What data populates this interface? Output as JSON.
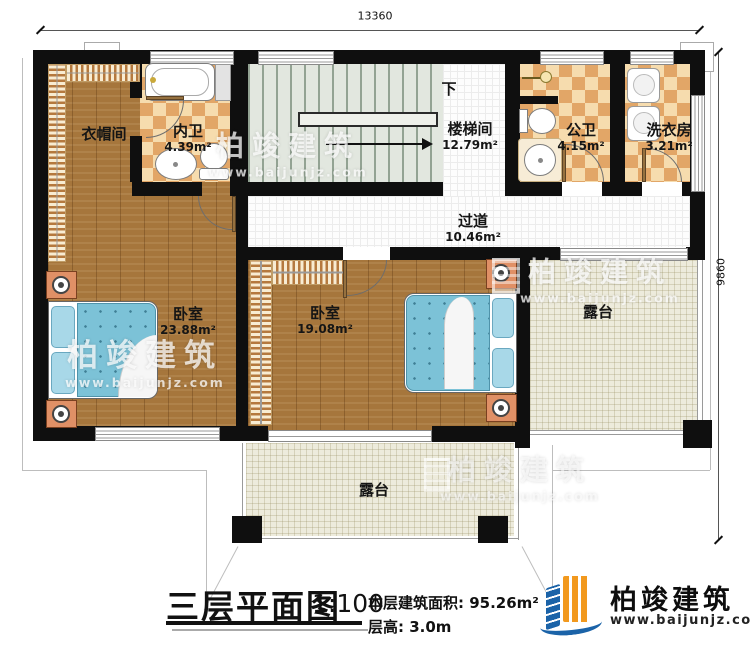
{
  "dimension_labels": {
    "top_width": "13360",
    "right_height": "9860"
  },
  "rooms": {
    "cloakroom": {
      "name": "衣帽间"
    },
    "inner_bath": {
      "name": "内卫",
      "area": "4.39m²"
    },
    "stairwell": {
      "name": "楼梯间",
      "area": "12.79m²",
      "down_label": "下"
    },
    "public_bath": {
      "name": "公卫",
      "area": "4.15m²"
    },
    "laundry": {
      "name": "洗衣房",
      "area": "3.21m²"
    },
    "hallway": {
      "name": "过道",
      "area": "10.46m²"
    },
    "bedroom_left": {
      "name": "卧室",
      "area": "23.88m²"
    },
    "bedroom_mid": {
      "name": "卧室",
      "area": "19.08m²"
    },
    "terrace_right": {
      "name": "露台"
    },
    "terrace_bottom": {
      "name": "露台"
    }
  },
  "title_block": {
    "title": "三层平面图",
    "scale": "1:100",
    "area_label": "本层建筑面积:",
    "area_value": "95.26m²",
    "floor_height_label": "层高:",
    "floor_height_value": "3.0m"
  },
  "brand": {
    "name": "柏竣建筑",
    "website": "www.baijunjz.com"
  },
  "watermark": {
    "name": "柏竣建筑",
    "website": "www.baijunjz.com"
  },
  "colors": {
    "wall": "#0f0f0f",
    "wood": "#a6763c",
    "checker_dark": "#e2a667",
    "checker_light": "#f6dcae",
    "stair": "#e2e7df",
    "terrace": "#edebdc",
    "bed_quilt": "#7cc2d7",
    "nightstand": "#e09066",
    "brand_blue": "#1b63a8",
    "brand_orange": "#f2991e"
  }
}
